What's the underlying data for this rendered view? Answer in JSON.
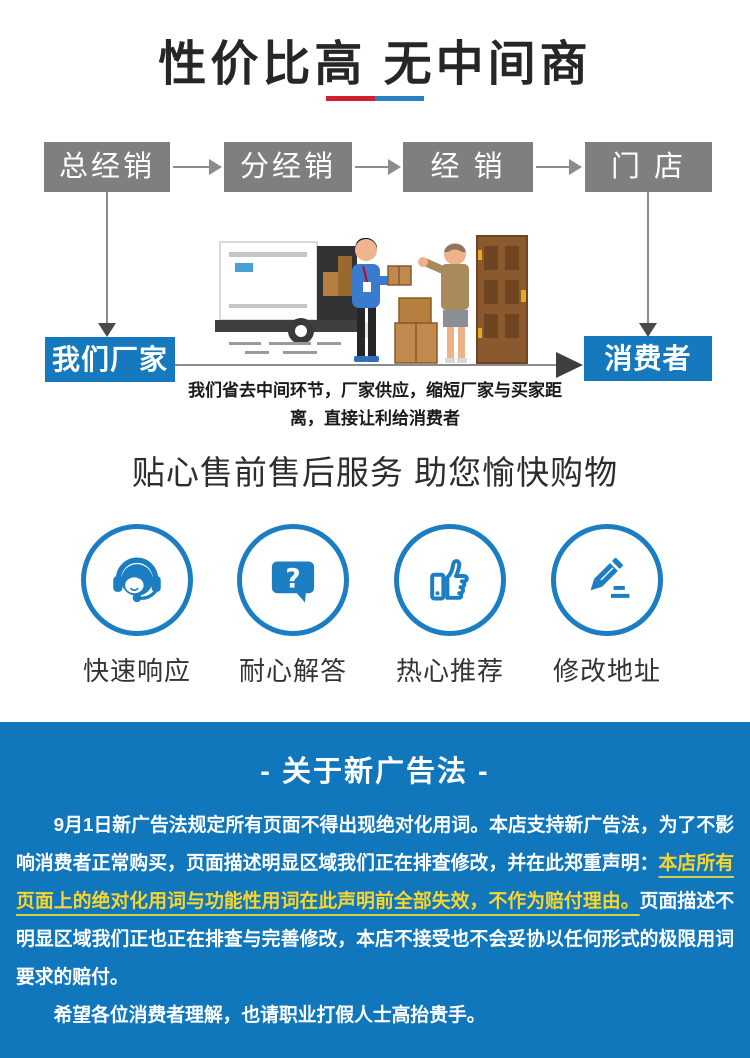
{
  "header": {
    "title": "性价比高 无中间商",
    "underline_colors": {
      "left": "#d0202e",
      "right": "#2a7fc2"
    }
  },
  "flow": {
    "chain": [
      {
        "label": "总经销"
      },
      {
        "label": "分经销"
      },
      {
        "label": "经 销"
      },
      {
        "label": "门 店"
      }
    ],
    "factory_label": "我们厂家",
    "consumer_label": "消费者",
    "caption": "我们省去中间环节，厂家供应，缩短厂家与买家距离，直接让利给消费者",
    "box_gray": "#7f7f7f",
    "accent_blue": "#1779bd"
  },
  "services": {
    "title": "贴心售前售后服务 助您愉快购物",
    "icon_blue": "#1b7ec2",
    "items": [
      {
        "icon": "headset-icon",
        "label": "快速响应"
      },
      {
        "icon": "question-bubble-icon",
        "label": "耐心解答"
      },
      {
        "icon": "thumbs-up-icon",
        "label": "热心推荐"
      },
      {
        "icon": "pencil-icon",
        "label": "修改地址"
      }
    ]
  },
  "notice": {
    "title": "- 关于新广告法 -",
    "bg_color": "#1177bd",
    "highlight_color": "#f7d52e",
    "paragraph": [
      {
        "style": "normal",
        "text": "9月1日新广告法规定所有页面不得出现绝对化用词。本店支持新广告法，为了不影响消费者正常购买，页面描述明显区域我们正在排查修改，并在此郑重声明："
      },
      {
        "style": "highlight",
        "text": "本店所有页面上的绝对化用词与功能性用词在此声明前全部失效，不作为赔付理由。"
      },
      {
        "style": "normal",
        "text": "页面描述不明显区域我们正也正在排查与完善修改，本店不接受也不会妥协以任何形式的极限用词要求的赔付。"
      }
    ],
    "closing": "希望各位消费者理解，也请职业打假人士高抬贵手。"
  }
}
